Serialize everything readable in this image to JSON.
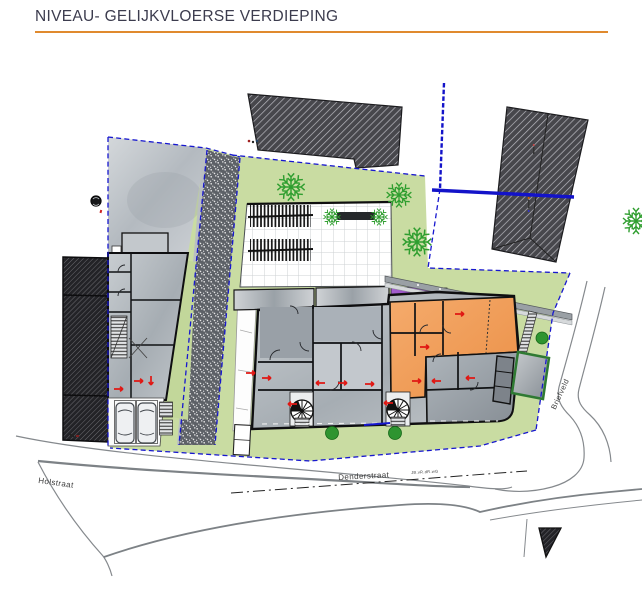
{
  "page": {
    "title": "NIVEAU- GELIJKVLOERSE VERDIEPING"
  },
  "plan": {
    "streets": [
      {
        "name": "Holstraat"
      },
      {
        "name": "Denderstraat"
      },
      {
        "name": "Briefveld"
      }
    ],
    "road_annotation": "JB.vR.dR.wG",
    "colors": {
      "accent_rule": "#E08A2E",
      "title_text": "#3C3C4E",
      "lawn_green": "#C9DCA2",
      "tree_green": "#2F9E2F",
      "boundary_blue": "#1717CF",
      "room_orange": "#F0A05C",
      "canopy_purple": "#9149BF",
      "door_marker_red": "#E01713",
      "existing_building_hatch": "#46464B"
    }
  }
}
